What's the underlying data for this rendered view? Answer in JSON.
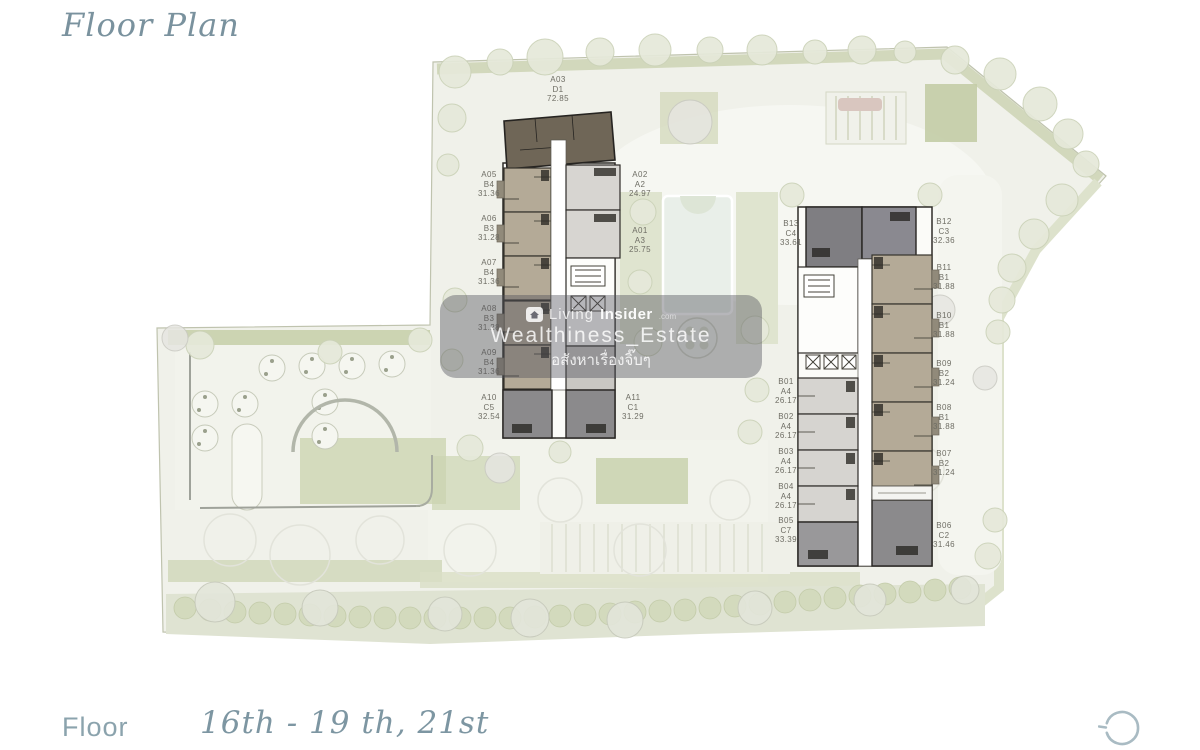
{
  "header": {
    "title": "Floor Plan"
  },
  "footer": {
    "floor_label": "Floor",
    "floor_value": "16th - 19 th, 21st"
  },
  "watermark": {
    "logo_icon": "home-icon",
    "brand_prefix": "Living",
    "brand_suffix": "Insider",
    "brand_tld": ".com",
    "line2": "Wealthiness_Estate",
    "line3": "อสังหาเรื่องจิ๊บๆ"
  },
  "icons": {
    "corner_mark": "open-circle-icon"
  },
  "plan": {
    "colors": {
      "site": "#f0f1ea",
      "green": "#ccd4b2",
      "tan_unit": "#b4aa97",
      "dark_unit": "#6f6657",
      "gray_unit": "#8b8a8c",
      "light_unit": "#d7d5d1",
      "wall": "#2e2c28",
      "accent_text": "#7a929e"
    },
    "units": [
      {
        "building": "A",
        "code": "A03",
        "type": "D1",
        "area": "72.85"
      },
      {
        "building": "A",
        "code": "A05",
        "type": "B4",
        "area": "31.36"
      },
      {
        "building": "A",
        "code": "A06",
        "type": "B3",
        "area": "31.28"
      },
      {
        "building": "A",
        "code": "A07",
        "type": "B4",
        "area": "31.36"
      },
      {
        "building": "A",
        "code": "A08",
        "type": "B3",
        "area": "31.28"
      },
      {
        "building": "A",
        "code": "A09",
        "type": "B4",
        "area": "31.36"
      },
      {
        "building": "A",
        "code": "A10",
        "type": "C5",
        "area": "32.54"
      },
      {
        "building": "A",
        "code": "A02",
        "type": "A2",
        "area": "24.97"
      },
      {
        "building": "A",
        "code": "A01",
        "type": "A3",
        "area": "25.75"
      },
      {
        "building": "A",
        "code": "A11",
        "type": "C1",
        "area": "31.29"
      },
      {
        "building": "B",
        "code": "B13",
        "type": "C4",
        "area": "33.61"
      },
      {
        "building": "B",
        "code": "B01",
        "type": "A4",
        "area": "26.17"
      },
      {
        "building": "B",
        "code": "B02",
        "type": "A4",
        "area": "26.17"
      },
      {
        "building": "B",
        "code": "B03",
        "type": "A4",
        "area": "26.17"
      },
      {
        "building": "B",
        "code": "B04",
        "type": "A4",
        "area": "26.17"
      },
      {
        "building": "B",
        "code": "B05",
        "type": "C7",
        "area": "33.39"
      },
      {
        "building": "B",
        "code": "B12",
        "type": "C3",
        "area": "32.36"
      },
      {
        "building": "B",
        "code": "B11",
        "type": "B1",
        "area": "31.88"
      },
      {
        "building": "B",
        "code": "B10",
        "type": "B1",
        "area": "31.88"
      },
      {
        "building": "B",
        "code": "B09",
        "type": "B2",
        "area": "31.24"
      },
      {
        "building": "B",
        "code": "B08",
        "type": "B1",
        "area": "31.88"
      },
      {
        "building": "B",
        "code": "B07",
        "type": "B2",
        "area": "31.24"
      },
      {
        "building": "B",
        "code": "B06",
        "type": "C2",
        "area": "31.46"
      }
    ]
  }
}
